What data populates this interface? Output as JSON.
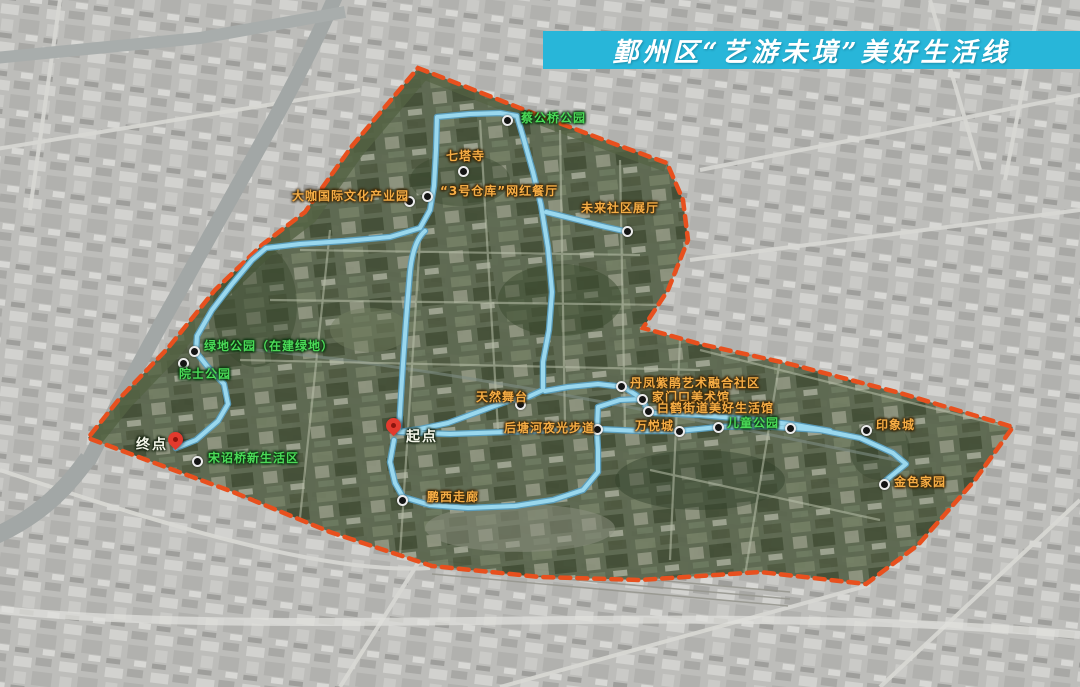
{
  "title": {
    "text": "鄞州区“艺游未境”美好生活线"
  },
  "colors": {
    "banner_bg": "#28b6d9",
    "banner_text": "#ffffff",
    "route_line": "#9ad8ee",
    "route_edge": "#5a9fc0",
    "boundary_dash": "#e8501e",
    "poi_green": "#4bdb58",
    "poi_orange": "#f6ad45",
    "poi_dot": "#141414",
    "pin_red": "#e23a2e"
  },
  "map": {
    "start": {
      "text": "起点",
      "pin": [
        394,
        433
      ],
      "label": [
        406,
        426
      ]
    },
    "end": {
      "text": "终点",
      "pin": [
        176,
        447
      ],
      "label": [
        136,
        434
      ]
    },
    "pois": [
      {
        "name": "蔡公桥公园",
        "color": "green",
        "dot": [
          507,
          120
        ],
        "label": [
          521,
          112
        ]
      },
      {
        "name": "七塔寺",
        "color": "orange",
        "dot": [
          463,
          171
        ],
        "label": [
          446,
          150
        ]
      },
      {
        "name": "大咖国际文化产业园",
        "color": "orange",
        "dot": [
          409,
          201
        ],
        "label": [
          292,
          190
        ]
      },
      {
        "name": "“3号仓库”网红餐厅",
        "color": "orange",
        "dot": [
          427,
          196
        ],
        "label": [
          440,
          185
        ]
      },
      {
        "name": "未来社区展厅",
        "color": "orange",
        "dot": [
          627,
          231
        ],
        "label": [
          581,
          202
        ]
      },
      {
        "name": "绿地公园（在建绿地）",
        "color": "green",
        "dot": [
          194,
          351
        ],
        "label": [
          204,
          340
        ]
      },
      {
        "name": "院士公园",
        "color": "green",
        "dot": [
          183,
          363
        ],
        "label": [
          179,
          368
        ]
      },
      {
        "name": "宋诏桥新生活区",
        "color": "green",
        "dot": [
          197,
          461
        ],
        "label": [
          208,
          452
        ]
      },
      {
        "name": "天然舞台",
        "color": "orange",
        "dot": [
          520,
          404
        ],
        "label": [
          476,
          391
        ]
      },
      {
        "name": "后塘河夜光步道",
        "color": "orange",
        "dot": [
          597,
          429
        ],
        "label": [
          504,
          422
        ]
      },
      {
        "name": "丹凤紫鹃艺术融合社区",
        "color": "orange",
        "dot": [
          621,
          386
        ],
        "label": [
          630,
          377
        ]
      },
      {
        "name": "家门口美术馆",
        "color": "orange",
        "dot": [
          642,
          399
        ],
        "label": [
          652,
          391
        ]
      },
      {
        "name": "白鹤街道美好生活馆",
        "color": "orange",
        "dot": [
          648,
          411
        ],
        "label": [
          657,
          402
        ]
      },
      {
        "name": "万悦城",
        "color": "orange",
        "dot": [
          679,
          431
        ],
        "label": [
          635,
          420
        ]
      },
      {
        "name": "儿童公园",
        "color": "green",
        "dot": [
          718,
          427
        ],
        "label": [
          727,
          417
        ]
      },
      {
        "name": "印象城",
        "color": "orange",
        "dot": [
          866,
          430
        ],
        "label": [
          876,
          419
        ]
      },
      {
        "name": "金色家园",
        "color": "orange",
        "dot": [
          884,
          484
        ],
        "label": [
          894,
          476
        ]
      },
      {
        "name": "鹏西走廊",
        "color": "orange",
        "dot": [
          402,
          500
        ],
        "label": [
          427,
          491
        ]
      }
    ],
    "extra_dots": [
      [
        790,
        428
      ]
    ]
  }
}
